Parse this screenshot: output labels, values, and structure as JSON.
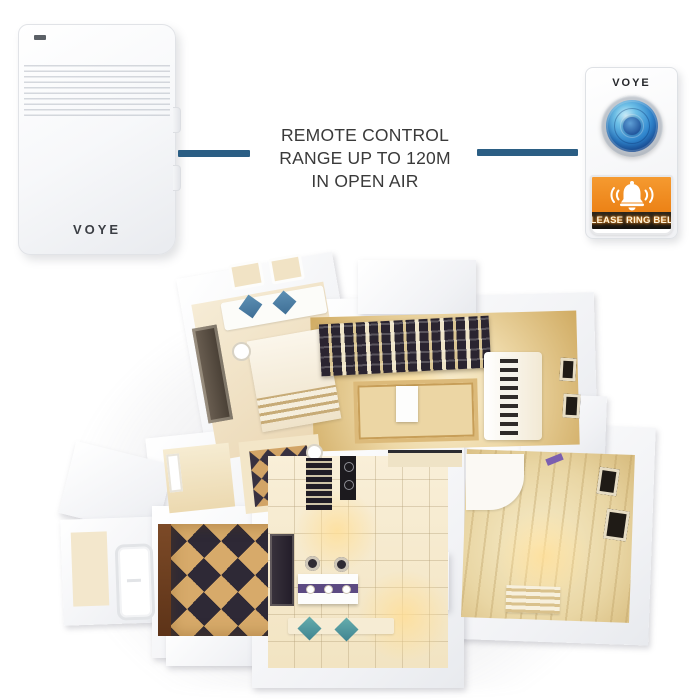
{
  "annotation": {
    "lines": [
      "REMOTE CONTROL",
      "RANGE UP TO 120M",
      "IN OPEN AIR"
    ]
  },
  "receiver": {
    "brand": "VOYE"
  },
  "remote": {
    "brand": "VOYE",
    "label": "PLEASE RING BELL"
  },
  "colors": {
    "connector_blue": "#2b5e84",
    "panel_orange": "#ee8a1d",
    "label_bar_dark": "#1e1a14",
    "button_blue": "#2f86cf",
    "annotation_text": "#3a3a3a"
  },
  "icons": {
    "bell": "bell-icon",
    "sound_waves": "sound-wave-icon",
    "led": "led-indicator"
  }
}
